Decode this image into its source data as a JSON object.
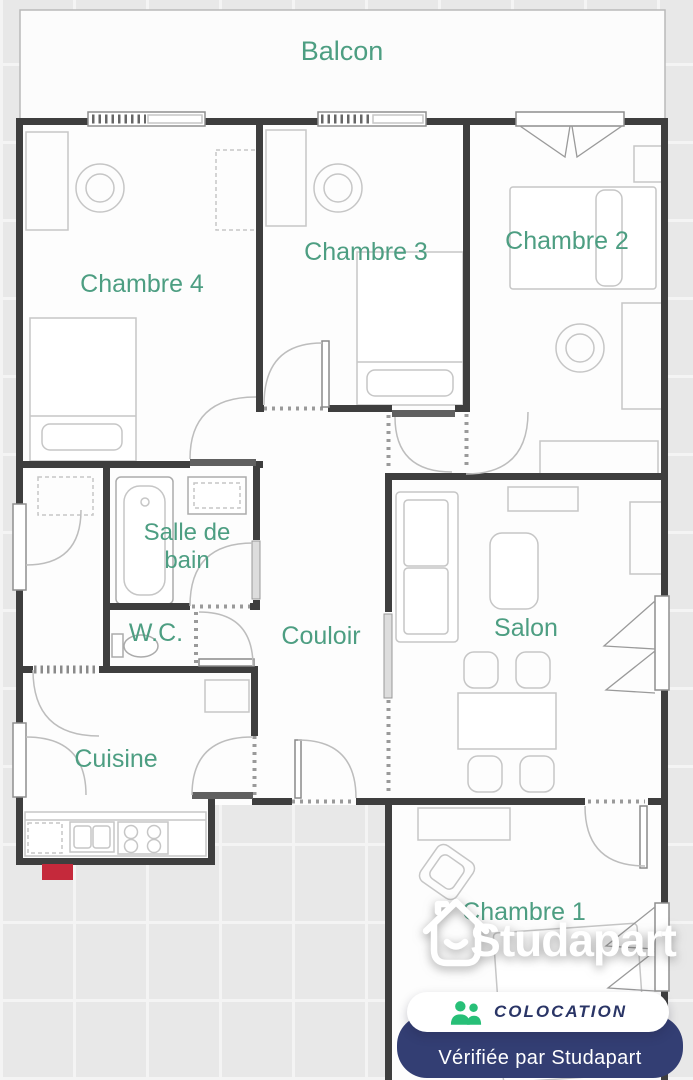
{
  "plan": {
    "rooms": {
      "balcon": "Balcon",
      "chambre_4": "Chambre 4",
      "chambre_3": "Chambre 3",
      "chambre_2": "Chambre 2",
      "salle_de_bain": [
        "Salle de",
        "bain"
      ],
      "wc": "W.C.",
      "couloir": "Couloir",
      "salon": "Salon",
      "cuisine": "Cuisine",
      "chambre_1": "Chambre 1"
    }
  },
  "watermark": {
    "brand": "Studapart",
    "icon": "house-smile-icon"
  },
  "badges": {
    "colocation": {
      "icon": "roommates-icon",
      "label": "COLOCATION"
    },
    "verified": {
      "label": "Vérifiée par Studapart"
    }
  },
  "colors": {
    "label_teal": "#4d9e82",
    "wall_dark": "#3e3e3e",
    "badge_navy": "#333e73",
    "badge_green": "#27bf77",
    "entrance_red": "#c5293b",
    "tile_gray": "#e8e8e8",
    "floor_white": "#fdfdfd"
  }
}
